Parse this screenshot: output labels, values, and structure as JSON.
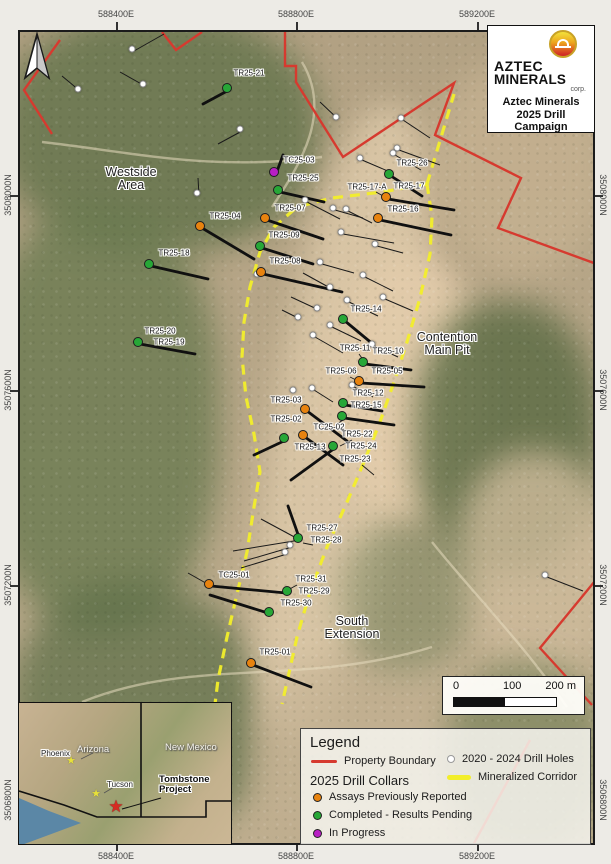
{
  "frame": {
    "top": [
      "588400E",
      "588800E",
      "589200E"
    ],
    "bottom": [
      "588400E",
      "588800E",
      "589200E"
    ],
    "left": [
      "3508000N",
      "3507600N",
      "3507200N"
    ],
    "right": [
      "3508000N",
      "3507600N",
      "3507200N"
    ],
    "left_partial": "3506800N",
    "right_partial": "3506800N"
  },
  "title_box": {
    "brand1": "AZTEC",
    "brand2": "MINERALS",
    "corp": "corp.",
    "line1": "Aztec Minerals",
    "line2": "2025 Drill",
    "line3": "Campaign"
  },
  "areas": [
    {
      "l1": "Westside",
      "l2": "Area",
      "x": 131,
      "y": 166
    },
    {
      "l1": "Contention",
      "l2": "Main Pit",
      "x": 447,
      "y": 331
    },
    {
      "l1": "South",
      "l2": "Extension",
      "x": 352,
      "y": 615
    }
  ],
  "legend": {
    "title": "Legend",
    "property_boundary": "Property Boundary",
    "collars_heading": "2025 Drill Collars",
    "collar_items": [
      {
        "label": "Assays Previously Reported",
        "status": "reported"
      },
      {
        "label": "Completed - Results Pending",
        "status": "completed"
      },
      {
        "label": "In Progress",
        "status": "inprogress"
      }
    ],
    "prev_label": "2020 - 2024 Drill Holes",
    "corridor_label": "Mineralized Corridor"
  },
  "scale": {
    "t0": "0",
    "t1": "100",
    "t2": "200 m"
  },
  "inset": {
    "state_az": "Arizona",
    "state_nm": "New Mexico",
    "city_phoenix": "Phoenix",
    "city_tucson": "Tucson",
    "project": "Tombstone Project",
    "star": "★"
  },
  "colors": {
    "boundary": "#d63a2f",
    "corridor": "#f2ee2a",
    "reported": "#e8830f",
    "completed": "#27a737",
    "inprogress": "#b81fc4",
    "prev": "#ffffff"
  },
  "holes_2025": [
    {
      "id": "TR25-21",
      "status": "completed",
      "dot": [
        227,
        88
      ],
      "label": [
        249,
        73
      ],
      "trace": [
        201,
        102
      ]
    },
    {
      "id": "TC25-03",
      "status": "inprogress",
      "dot": [
        274,
        172
      ],
      "label": [
        299,
        160
      ],
      "trace": [
        281,
        153
      ]
    },
    {
      "id": "TR25-25",
      "status": "completed",
      "dot": [
        278,
        190
      ],
      "label": [
        303,
        178
      ],
      "trace": [
        322,
        200
      ]
    },
    {
      "id": "TR25-26",
      "status": "completed",
      "dot": [
        389,
        174
      ],
      "label": [
        412,
        163
      ],
      "trace": [
        420,
        194
      ]
    },
    {
      "id": "TR25-17-A",
      "status": "reported",
      "label": [
        367,
        187
      ],
      "pointer": [
        374,
        190,
        383,
        195
      ]
    },
    {
      "id": "TR25-17",
      "status": "reported",
      "dot": [
        386,
        197
      ],
      "label": [
        409,
        186
      ],
      "trace": [
        452,
        208
      ]
    },
    {
      "id": "TR25-16",
      "status": "reported",
      "dot": [
        378,
        218
      ],
      "label": [
        403,
        209
      ],
      "trace": [
        449,
        233
      ]
    },
    {
      "id": "TR25-07",
      "status": "reported",
      "dot": [
        265,
        218
      ],
      "label": [
        290,
        208
      ],
      "trace": [
        321,
        237
      ]
    },
    {
      "id": "TR25-04",
      "status": "reported",
      "dot": [
        200,
        226
      ],
      "label": [
        225,
        216
      ],
      "trace": [
        252,
        257
      ]
    },
    {
      "id": "TR25-09",
      "status": "completed",
      "dot": [
        260,
        246
      ],
      "label": [
        284,
        235
      ],
      "trace": [
        311,
        262
      ]
    },
    {
      "id": "TR25-18",
      "status": "completed",
      "dot": [
        149,
        264
      ],
      "label": [
        174,
        253
      ],
      "trace": [
        206,
        277
      ]
    },
    {
      "id": "TR25-08",
      "status": "reported",
      "dot": [
        261,
        272
      ],
      "label": [
        285,
        261
      ],
      "trace": [
        340,
        290
      ]
    },
    {
      "id": "TR25-14",
      "status": "completed",
      "dot": [
        343,
        319
      ],
      "label": [
        366,
        309
      ],
      "trace": [
        372,
        343
      ]
    },
    {
      "id": "TR25-20",
      "status": "completed",
      "dot": [
        138,
        342
      ],
      "label": [
        160,
        331
      ],
      "trace": [
        193,
        352
      ]
    },
    {
      "id": "TR25-19",
      "status": "completed",
      "label": [
        169,
        342
      ],
      "pointer": [
        152,
        344,
        143,
        344
      ]
    },
    {
      "id": "TR25-11",
      "status": "completed",
      "label": [
        355,
        348
      ],
      "pointer": [
        357,
        352,
        362,
        359
      ]
    },
    {
      "id": "TR25-10",
      "status": "completed",
      "dot": [
        363,
        362
      ],
      "label": [
        388,
        351
      ],
      "trace": [
        409,
        368
      ]
    },
    {
      "id": "TR25-06",
      "status": "reported",
      "label": [
        341,
        371
      ],
      "pointer": [
        348,
        375,
        356,
        379
      ]
    },
    {
      "id": "TR25-05",
      "status": "reported",
      "dot": [
        359,
        381
      ],
      "label": [
        387,
        371
      ],
      "trace": [
        422,
        385
      ]
    },
    {
      "id": "TR25-03",
      "status": "reported",
      "dot": [
        305,
        409
      ],
      "label": [
        286,
        400
      ],
      "trace": [
        345,
        439
      ]
    },
    {
      "id": "TR25-02",
      "status": "completed",
      "dot": [
        284,
        438
      ],
      "label": [
        286,
        419
      ],
      "trace": [
        252,
        453
      ]
    },
    {
      "id": "TR25-12",
      "status": "completed",
      "dot": [
        343,
        403
      ],
      "label": [
        368,
        393
      ],
      "trace": [
        380,
        409
      ]
    },
    {
      "id": "TR25-15",
      "status": "completed",
      "dot": [
        342,
        416
      ],
      "label": [
        366,
        405
      ],
      "trace": [
        392,
        423
      ]
    },
    {
      "id": "TC25-02",
      "status": "completed",
      "label": [
        329,
        427
      ],
      "pointer": [
        335,
        422,
        341,
        418
      ]
    },
    {
      "id": "TR25-22",
      "status": "completed",
      "label": [
        357,
        434
      ],
      "pointer": [
        350,
        438,
        338,
        444
      ]
    },
    {
      "id": "TR25-13",
      "status": "reported",
      "dot": [
        303,
        435
      ],
      "label": [
        310,
        447
      ],
      "trace": [
        341,
        463
      ]
    },
    {
      "id": "TR25-24",
      "status": "completed",
      "dot": [
        333,
        446
      ],
      "label": [
        361,
        446
      ],
      "trace": [
        289,
        478
      ]
    },
    {
      "id": "TR25-23",
      "status": "completed",
      "label": [
        355,
        459
      ],
      "pointer": [
        360,
        463,
        372,
        473
      ]
    },
    {
      "id": "TR25-27",
      "status": "completed",
      "dot": [
        298,
        538
      ],
      "label": [
        322,
        528
      ],
      "trace": [
        286,
        504
      ]
    },
    {
      "id": "TR25-28",
      "status": "completed",
      "label": [
        326,
        540
      ],
      "pointer": [
        311,
        543,
        301,
        541
      ]
    },
    {
      "id": "TC25-01",
      "status": "reported",
      "dot": [
        209,
        584
      ],
      "label": [
        234,
        575
      ],
      "trace": [
        284,
        591
      ]
    },
    {
      "id": "TR25-31",
      "status": "completed",
      "label": [
        311,
        579
      ],
      "pointer": [
        295,
        583,
        284,
        589
      ]
    },
    {
      "id": "TR25-29",
      "status": "completed",
      "dot": [
        287,
        591
      ],
      "label": [
        314,
        591
      ]
    },
    {
      "id": "TR25-30",
      "status": "completed",
      "dot": [
        269,
        612
      ],
      "label": [
        296,
        603
      ],
      "trace": [
        208,
        593
      ]
    },
    {
      "id": "TR25-01",
      "status": "reported",
      "dot": [
        251,
        663
      ],
      "label": [
        275,
        652
      ],
      "trace": [
        309,
        685
      ]
    }
  ],
  "holes_prev": [
    [
      132,
      49,
      162,
      32
    ],
    [
      78,
      89,
      60,
      74
    ],
    [
      143,
      84,
      118,
      70
    ],
    [
      240,
      129,
      216,
      142
    ],
    [
      197,
      193,
      196,
      176
    ],
    [
      336,
      117,
      318,
      100
    ],
    [
      401,
      118,
      428,
      136
    ],
    [
      397,
      148,
      438,
      163
    ],
    [
      360,
      158,
      388,
      170
    ],
    [
      393,
      153,
      419,
      168
    ],
    [
      305,
      200,
      338,
      217
    ],
    [
      333,
      208,
      361,
      216
    ],
    [
      346,
      209,
      370,
      221
    ],
    [
      341,
      232,
      392,
      241
    ],
    [
      375,
      244,
      401,
      251
    ],
    [
      257,
      274
    ],
    [
      320,
      262,
      352,
      271
    ],
    [
      363,
      275,
      391,
      289
    ],
    [
      330,
      287,
      301,
      271
    ],
    [
      383,
      297,
      411,
      309
    ],
    [
      347,
      300,
      376,
      314
    ],
    [
      317,
      308,
      289,
      295
    ],
    [
      298,
      317,
      280,
      308
    ],
    [
      330,
      325,
      359,
      339
    ],
    [
      313,
      335,
      341,
      351
    ],
    [
      372,
      344,
      396,
      355
    ],
    [
      352,
      385,
      371,
      395
    ],
    [
      312,
      388,
      331,
      400
    ],
    [
      293,
      390
    ],
    [
      290,
      545,
      242,
      559
    ],
    [
      285,
      552,
      239,
      566
    ],
    [
      545,
      575,
      581,
      589
    ]
  ],
  "extra_lines": [
    [
      298,
      538,
      231,
      549
    ],
    [
      298,
      538,
      259,
      517
    ],
    [
      209,
      584,
      186,
      571
    ]
  ],
  "overlays": {
    "boundary": [
      "58,38 22,88 50,132",
      "160,30 174,48 200,30",
      "283,30 283,64 294,64 294,80 341,155 452,81 433,133 519,176 496,226 611,268",
      "611,557 538,646 590,703",
      "528,738 470,845"
    ],
    "corridor": [
      "425,182 452,92",
      "425,182 380,190 330,196 295,205 272,225 258,250 248,285 242,320 240,355 244,395 252,432 258,470 252,505 245,550 235,592 225,635 216,678 213,702",
      "425,182 430,215 428,252 418,296 405,340 392,380 378,420 362,460 345,500 325,545 308,590 295,635 285,680 280,702"
    ]
  }
}
